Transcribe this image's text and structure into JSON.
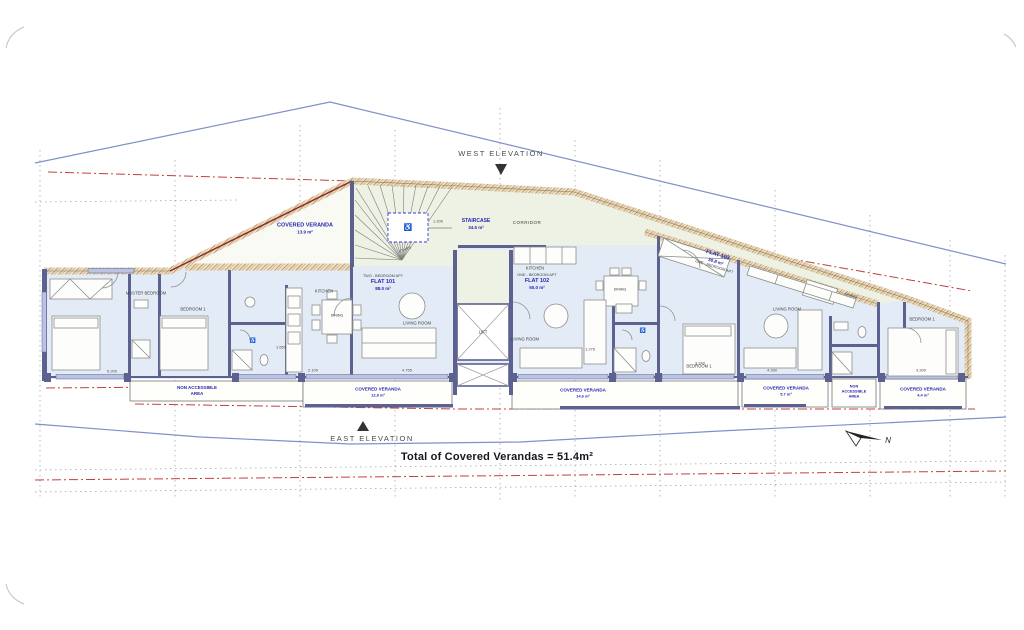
{
  "plan": {
    "west_elevation": "WEST ELEVATION",
    "east_elevation": "EAST ELEVATION",
    "total_note": "Total of Covered Verandas = 51.4m²",
    "north": "N"
  },
  "flats": [
    {
      "type": "TWO - BEDROOM APT",
      "name": "FLAT 101",
      "area": "88.0 m²"
    },
    {
      "type": "ONE - BEDROOM APT",
      "name": "FLAT 102",
      "area": "50.0 m²"
    },
    {
      "type": "ONE - BEDROOM APT",
      "name": "FLAT 103",
      "area": "50.8 m²"
    }
  ],
  "rooms": {
    "corridor": "CORRIDOR",
    "kitchen": "KITCHEN",
    "dining": "DINING",
    "living": "LIVING ROOM",
    "master_bedroom": "MASTER BEDROOM",
    "bedroom1": "BEDROOM 1",
    "lift": "LIFT",
    "stairs": "STAIRS"
  },
  "areas": {
    "veranda_top": {
      "name": "COVERED VERANDA",
      "area": "13.9 m²"
    },
    "staircase": {
      "name": "STAIRCASE",
      "area": "34.5 m²"
    },
    "non_accessible_left": {
      "l1": "NON ACCESSIBLE",
      "l2": "AREA"
    },
    "veranda_101": {
      "name": "COVERED VERANDA",
      "area": "12.8 m²"
    },
    "veranda_102": {
      "name": "COVERED VERANDA",
      "area": "14.6 m²"
    },
    "veranda_103a": {
      "name": "COVERED VERANDA",
      "area": "5.7 m²"
    },
    "non_accessible_right": {
      "l1": "NON",
      "l2": "ACCESSIBLE",
      "l3": "AREA"
    },
    "veranda_103b": {
      "name": "COVERED VERANDA",
      "area": "4.4 m²"
    }
  },
  "dimensions": {
    "stairs": "1.200",
    "master": "5.200",
    "bath101": "1.650",
    "kitchen101": "2.100",
    "living101": "4.755",
    "flat102": "1.276",
    "bedroom102": "3.240",
    "living103": "4.330",
    "bedroom103": "3.200"
  },
  "icons": {
    "wheelchair": "♿"
  },
  "colors": {
    "floor_blue": "#e3ecf6",
    "floor_green": "#eef2e4",
    "wall_hatch_dark": "#a87f48",
    "wall_navy": "#5c6190",
    "label_blue": "#2626b0",
    "boundary_blue": "#8090c8",
    "boundary_red": "#c04040"
  }
}
